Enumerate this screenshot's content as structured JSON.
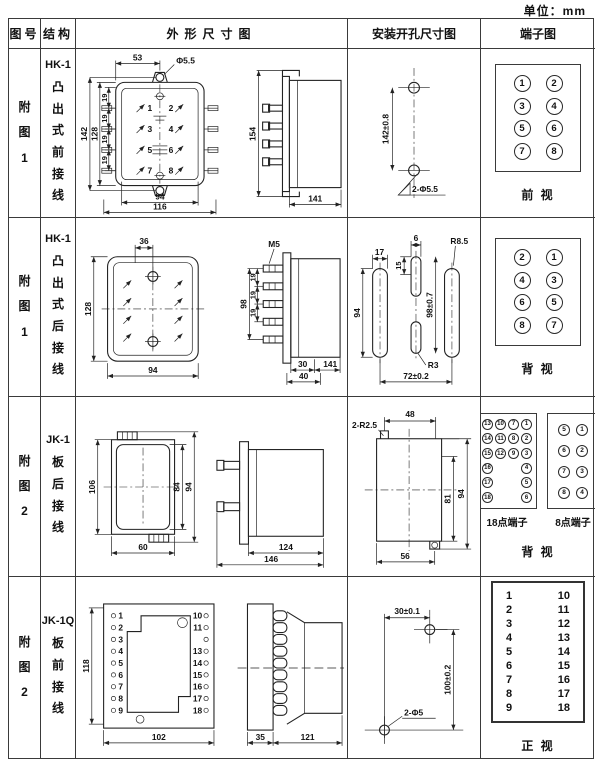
{
  "unit_label": "单位：mm",
  "table": {
    "headers": [
      "图号",
      "结构",
      "外形尺寸图",
      "安装开孔尺寸图",
      "端子图"
    ],
    "rows": [
      {
        "fig_no": "附图1",
        "model": "HK-1",
        "structure": "凸出式前接线",
        "outline": {
          "front": {
            "top_width": "53",
            "hole": "Φ5.5",
            "h_outer": "142",
            "h_inner": "128",
            "pitch": [
              "19",
              "19",
              "19",
              "19"
            ],
            "w_inner": "94",
            "w_outer": "116",
            "terminals": [
              "1",
              "2",
              "3",
              "4",
              "5",
              "6",
              "7",
              "8"
            ]
          },
          "side": {
            "height": "154",
            "depth": "141"
          }
        },
        "install": {
          "spacing": "142±0.8",
          "holes": "2-Φ5.5"
        },
        "terminal": {
          "grid": [
            [
              "1",
              "2"
            ],
            [
              "3",
              "4"
            ],
            [
              "5",
              "6"
            ],
            [
              "7",
              "8"
            ]
          ],
          "caption": "前 视"
        }
      },
      {
        "fig_no": "附图1",
        "model": "HK-1",
        "structure": "凸出式后接线",
        "outline": {
          "front": {
            "top_width": "36",
            "height": "128",
            "width": "94"
          },
          "side": {
            "thread": "M5",
            "height": "98",
            "pitch": [
              "19",
              "19",
              "19"
            ],
            "d1": "30",
            "d2": "40",
            "depth": "141"
          }
        },
        "install": {
          "slot_w": "17",
          "mid_w": "6",
          "mid_top": "15",
          "slot_h": "94",
          "v_spacing": "98±0.7",
          "r_slot": "R8.5",
          "r_mid": "R3",
          "h_spacing": "72±0.2"
        },
        "terminal": {
          "grid": [
            [
              "2",
              "1"
            ],
            [
              "4",
              "3"
            ],
            [
              "6",
              "5"
            ],
            [
              "8",
              "7"
            ]
          ],
          "caption": "背 视"
        }
      },
      {
        "fig_no": "附图2",
        "model": "JK-1",
        "structure": "板后接线",
        "outline": {
          "front": {
            "height": "106",
            "h_inner": "84",
            "h_outer": "94",
            "width": "60"
          },
          "side": {
            "depth_inner": "124",
            "depth_outer": "146"
          }
        },
        "install": {
          "notch": "2-R2.5",
          "top": "48",
          "h_inner": "81",
          "h_outer": "94",
          "bottom": "56"
        },
        "terminal": {
          "t18": {
            "label": "18点端子",
            "grid": [
              [
                "13",
                "10",
                "7",
                "1"
              ],
              [
                "14",
                "11",
                "8",
                "2"
              ],
              [
                "15",
                "12",
                "9",
                "3"
              ],
              [
                "16",
                "",
                "",
                "4"
              ],
              [
                "17",
                "",
                "",
                "5"
              ],
              [
                "18",
                "",
                "",
                "6"
              ]
            ]
          },
          "t8": {
            "label": "8点端子",
            "grid": [
              [
                "5",
                "1"
              ],
              [
                "6",
                "2"
              ],
              [
                "7",
                "3"
              ],
              [
                "8",
                "4"
              ]
            ]
          },
          "caption": "背 视"
        }
      },
      {
        "fig_no": "附图2",
        "model": "JK-1Q",
        "structure": "板前接线",
        "outline": {
          "front": {
            "height": "118",
            "width": "102",
            "left": [
              "1",
              "2",
              "3",
              "4",
              "5",
              "6",
              "7",
              "8",
              "9"
            ],
            "right": [
              "10",
              "11",
              "12",
              "13",
              "14",
              "15",
              "16",
              "17",
              "18"
            ]
          },
          "side": {
            "d1": "35",
            "d2": "121"
          }
        },
        "install": {
          "h_spacing": "30±0.1",
          "v_spacing": "100±0.2",
          "holes": "2-Φ5"
        },
        "terminal": {
          "grid": [
            [
              "1",
              "10"
            ],
            [
              "2",
              "11"
            ],
            [
              "3",
              "12"
            ],
            [
              "4",
              "13"
            ],
            [
              "5",
              "14"
            ],
            [
              "6",
              "15"
            ],
            [
              "7",
              "16"
            ],
            [
              "8",
              "17"
            ],
            [
              "9",
              "18"
            ]
          ],
          "caption": "正 视"
        }
      }
    ]
  }
}
